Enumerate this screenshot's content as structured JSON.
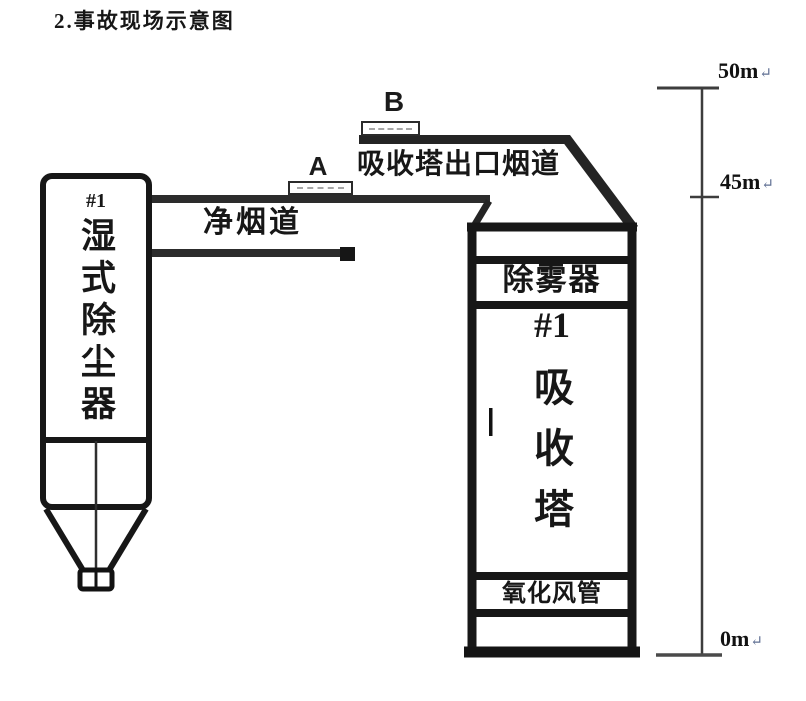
{
  "title": "2.事故现场示意图",
  "dust_collector": {
    "number": "#1",
    "name": "湿式除尘器"
  },
  "ducts": {
    "clean_flue": "净烟道",
    "outlet_flue": "吸收塔出口烟道"
  },
  "points": {
    "a": "A",
    "b": "B"
  },
  "tower": {
    "demister": "除雾器",
    "number": "#1",
    "name": "吸收塔",
    "oxidation_duct": "氧化风管"
  },
  "scale": {
    "markers": [
      {
        "label": "50m"
      },
      {
        "label": "45m"
      },
      {
        "label": "0m"
      }
    ],
    "return_mark": "↵"
  },
  "colors": {
    "line": "#1a1a1a",
    "duct_line": "#2c2c2c",
    "scale_line": "#3d3d3d",
    "return_mark": "#5f6f93"
  }
}
